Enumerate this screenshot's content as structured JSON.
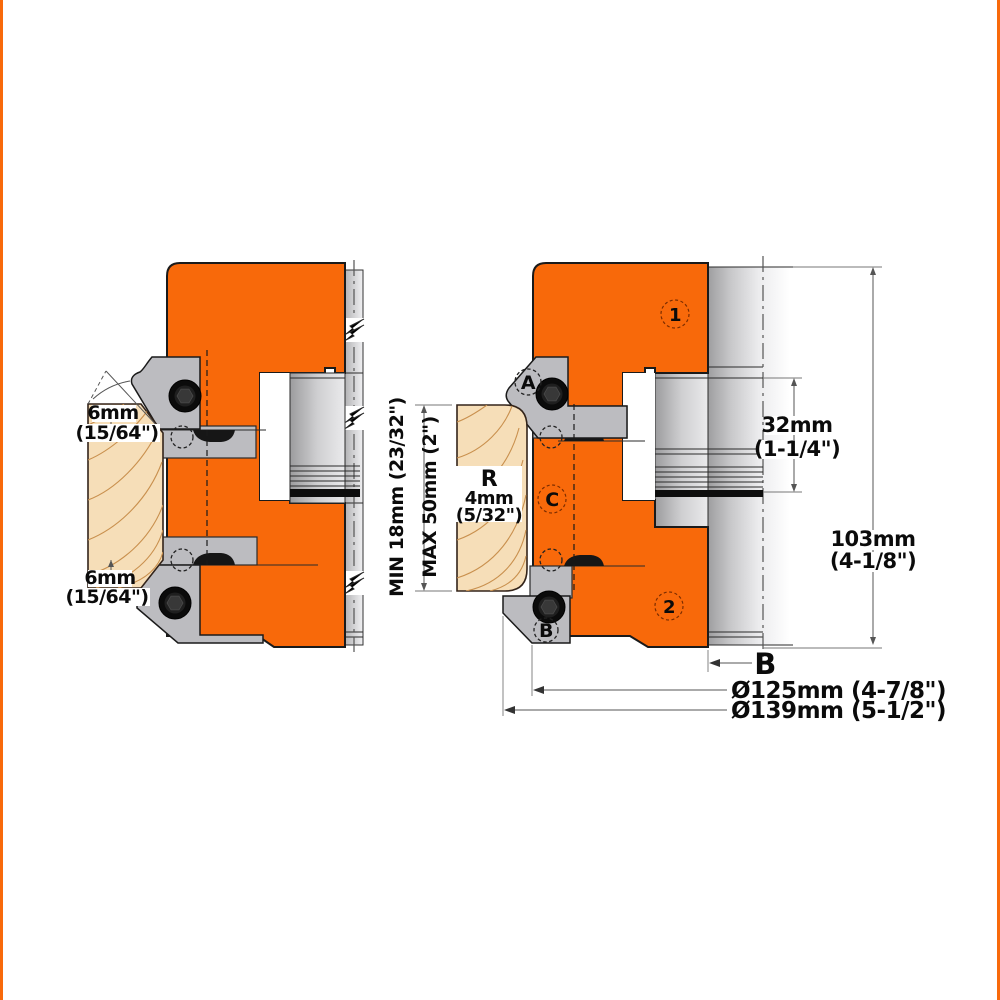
{
  "image": {
    "type": "technical-drawing",
    "subject": "cutter head cross-section views with profile knives and workpiece"
  },
  "colors": {
    "body_orange": "#f8690a",
    "steel_gray": "#bcbcc0",
    "cylinder_gray": "#aeaeb0",
    "wood_tan": "#f6deb8",
    "wood_grain": "#c9904e",
    "line_black": "#1a1a1a",
    "dim_gray": "#555555"
  },
  "left_view": {
    "top_dim": {
      "value": "6mm",
      "inches": "(15/64\")"
    },
    "bottom_dim": {
      "value": "6mm",
      "inches": "(15/64\")"
    }
  },
  "right_view": {
    "marker_1": "1",
    "marker_2": "2",
    "marker_a": "A",
    "marker_b": "B",
    "marker_c": "C",
    "radius_label": {
      "r": "R",
      "value": "4mm",
      "inches": "(5/32\")"
    },
    "stock_min": "MIN 18mm (23/32\")",
    "stock_max": "MAX 50mm  (2\")",
    "bore_dim": {
      "value": "32mm",
      "inches": "(1-1/4\")"
    },
    "height_dim": {
      "value": "103mm",
      "inches": "(4-1/8\")"
    },
    "width_label": "B",
    "dia_cutting": "Ø125mm (4-7/8\")",
    "dia_max": "Ø139mm (5-1/2\")"
  }
}
